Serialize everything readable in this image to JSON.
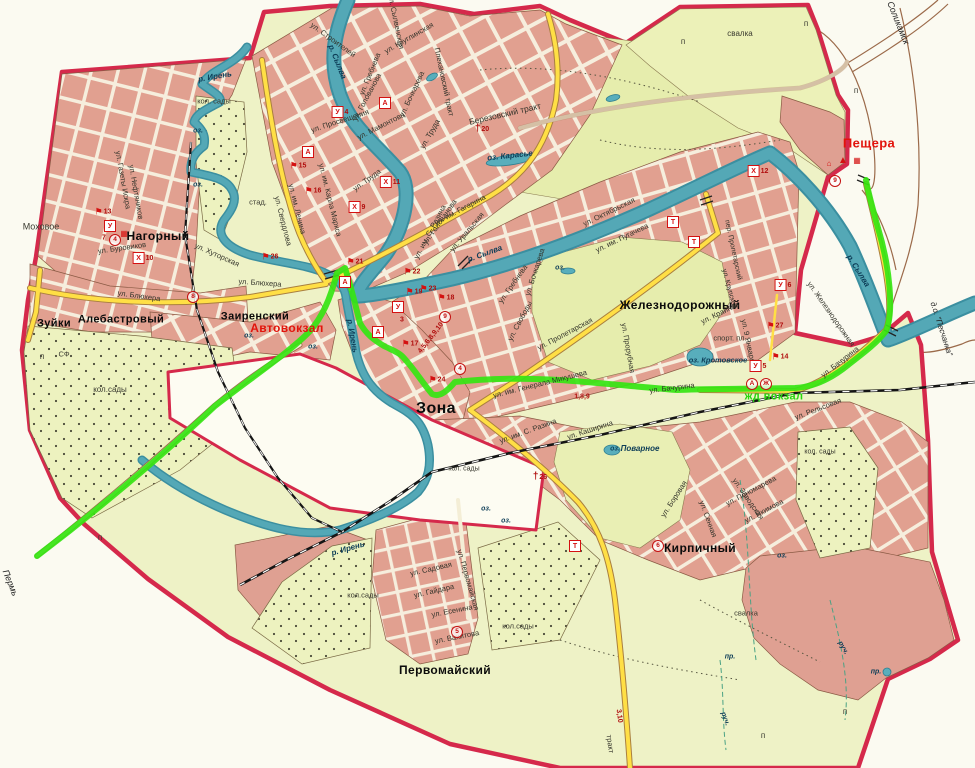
{
  "map": {
    "title": "План города (Кунгур)",
    "colors": {
      "boundary": "#d5294b",
      "water": "#4aa0ae",
      "route_highlight": "#35e512",
      "main_road": "#ffdf45",
      "urban_block": "#e1a090",
      "land": "#eef2c6",
      "park": "#e6edad",
      "railway": "#151515",
      "label_red": "#e2140c",
      "label_green": "#27d60e"
    },
    "labels": [
      {
        "t": "Нагорный",
        "x": 158,
        "y": 236,
        "cls": "town",
        "s": 12
      },
      {
        "t": "Зуйки",
        "x": 54,
        "y": 324,
        "cls": "town",
        "s": 11
      },
      {
        "t": "Алебастровый",
        "x": 121,
        "y": 320,
        "cls": "town",
        "s": 11
      },
      {
        "t": "Заиренский",
        "x": 255,
        "y": 317,
        "cls": "town",
        "s": 11
      },
      {
        "t": "Зона",
        "x": 436,
        "y": 409,
        "cls": "town",
        "s": 16
      },
      {
        "t": "Железнодорожный",
        "x": 680,
        "y": 305,
        "cls": "town",
        "s": 12
      },
      {
        "t": "Кирпичный",
        "x": 700,
        "y": 548,
        "cls": "town",
        "s": 12
      },
      {
        "t": "Первомайский",
        "x": 445,
        "y": 670,
        "cls": "town",
        "s": 12
      },
      {
        "t": "Моховое",
        "x": 41,
        "y": 227,
        "cls": "poi",
        "s": 9
      },
      {
        "t": "Пещера",
        "x": 869,
        "y": 143,
        "cls": "town-red",
        "s": 13
      },
      {
        "t": "Автовокзал",
        "x": 287,
        "y": 328,
        "cls": "town-red",
        "s": 12
      },
      {
        "t": "жд вокзал",
        "x": 774,
        "y": 397,
        "cls": "town-green",
        "s": 11
      },
      {
        "t": "Соликамск",
        "x": 898,
        "y": 23,
        "r": 68,
        "cls": "dir"
      },
      {
        "t": "Пермь",
        "x": 10,
        "y": 583,
        "r": 68,
        "cls": "dir"
      },
      {
        "t": "д.о. \"Песчанка\"",
        "x": 941,
        "y": 329,
        "r": 72,
        "cls": "dir",
        "s": 8
      },
      {
        "t": "ул. Строителей",
        "x": 333,
        "y": 40,
        "r": 36,
        "cls": "street"
      },
      {
        "t": "ул. Сылвенская",
        "x": 396,
        "y": 22,
        "r": 78,
        "cls": "street"
      },
      {
        "t": "ул. Круглинская",
        "x": 409,
        "y": 38,
        "r": -30,
        "cls": "street"
      },
      {
        "t": "Плехановский тракт",
        "x": 444,
        "y": 82,
        "r": 78,
        "cls": "street"
      },
      {
        "t": "Березовский тракт",
        "x": 505,
        "y": 114,
        "r": -13,
        "cls": "street",
        "s": 8.5
      },
      {
        "t": "ул. Труда",
        "x": 367,
        "y": 180,
        "r": -36,
        "cls": "street"
      },
      {
        "t": "ул. Труда",
        "x": 430,
        "y": 134,
        "r": -60,
        "cls": "street"
      },
      {
        "t": "ул. им. Карла Маркса",
        "x": 330,
        "y": 200,
        "r": 76,
        "cls": "street"
      },
      {
        "t": "ул. им. Ленина",
        "x": 297,
        "y": 209,
        "r": 76,
        "cls": "street"
      },
      {
        "t": "ул. Свердлова",
        "x": 283,
        "y": 221,
        "r": 76,
        "cls": "street"
      },
      {
        "t": "ул. им. Гагарина",
        "x": 460,
        "y": 210,
        "r": -28,
        "cls": "street"
      },
      {
        "t": "ул. Уральская",
        "x": 467,
        "y": 232,
        "r": -50,
        "cls": "street"
      },
      {
        "t": "ул. Голованова",
        "x": 440,
        "y": 222,
        "r": -55,
        "cls": "street"
      },
      {
        "t": "ул. Голованова",
        "x": 367,
        "y": 97,
        "r": -62,
        "cls": "street"
      },
      {
        "t": "ул. Гребнева",
        "x": 370,
        "y": 74,
        "r": -68,
        "cls": "street"
      },
      {
        "t": "ул. Гребнева",
        "x": 513,
        "y": 284,
        "r": -55,
        "cls": "street"
      },
      {
        "t": "ул. Мамонтова",
        "x": 381,
        "y": 126,
        "r": -27,
        "cls": "street"
      },
      {
        "t": "ул. Бочкарева",
        "x": 412,
        "y": 94,
        "r": -65,
        "cls": "street"
      },
      {
        "t": "ул. Бочкарева",
        "x": 535,
        "y": 272,
        "r": -72,
        "cls": "street"
      },
      {
        "t": "ул. Просвещения",
        "x": 340,
        "y": 121,
        "r": -18,
        "cls": "street"
      },
      {
        "t": "ул. Газеты Искра",
        "x": 123,
        "y": 180,
        "r": 80,
        "cls": "street"
      },
      {
        "t": "ул. Нефтяников",
        "x": 136,
        "y": 192,
        "r": 80,
        "cls": "street"
      },
      {
        "t": "ул. Буровиков",
        "x": 122,
        "y": 248,
        "r": -8,
        "cls": "street"
      },
      {
        "t": "ул. Блюхера",
        "x": 139,
        "y": 296,
        "r": 8,
        "cls": "street"
      },
      {
        "t": "ул. Блюхера",
        "x": 260,
        "y": 283,
        "r": 4,
        "cls": "street"
      },
      {
        "t": "ул. Хуторская",
        "x": 217,
        "y": 255,
        "r": 24,
        "cls": "street"
      },
      {
        "t": "ул. Свободы",
        "x": 520,
        "y": 321,
        "r": -62,
        "cls": "street"
      },
      {
        "t": "ул. Пролетарская",
        "x": 565,
        "y": 334,
        "r": -28,
        "cls": "street"
      },
      {
        "t": "ул. им. Генерала Микушева",
        "x": 540,
        "y": 384,
        "r": -14,
        "cls": "street"
      },
      {
        "t": "ул. Бачурина",
        "x": 672,
        "y": 388,
        "r": -7,
        "cls": "street"
      },
      {
        "t": "ул. Бачурина",
        "x": 840,
        "y": 362,
        "r": -38,
        "cls": "street"
      },
      {
        "t": "ул. Октябрьская",
        "x": 609,
        "y": 212,
        "r": -26,
        "cls": "street"
      },
      {
        "t": "ул. им. Пугачева",
        "x": 622,
        "y": 238,
        "r": -26,
        "cls": "street"
      },
      {
        "t": "ул. 9 Января",
        "x": 748,
        "y": 341,
        "r": 78,
        "cls": "street"
      },
      {
        "t": "ул. Железнодорожная",
        "x": 831,
        "y": 314,
        "r": 55,
        "cls": "street"
      },
      {
        "t": "ул. Крайняя",
        "x": 720,
        "y": 313,
        "r": -26,
        "cls": "street"
      },
      {
        "t": "пер. Пролетарский",
        "x": 733,
        "y": 250,
        "r": 78,
        "cls": "street",
        "s": 7
      },
      {
        "t": "ул. Прорубная",
        "x": 628,
        "y": 348,
        "r": 80,
        "cls": "street"
      },
      {
        "t": "ул. им. С. Разина",
        "x": 430,
        "y": 232,
        "r": -62,
        "cls": "street"
      },
      {
        "t": "ул. им. С. Разина",
        "x": 528,
        "y": 431,
        "r": -20,
        "cls": "street"
      },
      {
        "t": "ул. Каширина",
        "x": 590,
        "y": 430,
        "r": -18,
        "cls": "street"
      },
      {
        "t": "ул. Боровая",
        "x": 674,
        "y": 499,
        "r": -57,
        "cls": "street"
      },
      {
        "t": "ул. Заводская",
        "x": 748,
        "y": 499,
        "r": 55,
        "cls": "street"
      },
      {
        "t": "ул. Пономарева",
        "x": 751,
        "y": 491,
        "r": -28,
        "cls": "street"
      },
      {
        "t": "ул. Сенная",
        "x": 708,
        "y": 519,
        "r": 70,
        "cls": "street"
      },
      {
        "t": "ул. Якимова",
        "x": 764,
        "y": 511,
        "r": -28,
        "cls": "street"
      },
      {
        "t": "ул. Садовая",
        "x": 431,
        "y": 569,
        "r": -13,
        "cls": "street"
      },
      {
        "t": "ул. Гайдара",
        "x": 434,
        "y": 591,
        "r": -13,
        "cls": "street"
      },
      {
        "t": "ул. Есенина",
        "x": 452,
        "y": 611,
        "r": -11,
        "cls": "street"
      },
      {
        "t": "ул. Вахитова",
        "x": 457,
        "y": 637,
        "r": -11,
        "cls": "street"
      },
      {
        "t": "ул. Первомайская",
        "x": 468,
        "y": 580,
        "r": 74,
        "cls": "street"
      },
      {
        "t": "ул. Рельсовая",
        "x": 818,
        "y": 409,
        "r": -21,
        "cls": "street"
      },
      {
        "t": "ул. Крупской",
        "x": 729,
        "y": 289,
        "r": 75,
        "cls": "street",
        "s": 7
      },
      {
        "t": "тракт",
        "x": 610,
        "y": 744,
        "r": 82,
        "cls": "street"
      },
      {
        "t": "р. Ирень",
        "x": 215,
        "y": 77,
        "r": -10,
        "cls": "water"
      },
      {
        "t": "р. Ирень",
        "x": 352,
        "y": 336,
        "r": 80,
        "cls": "water"
      },
      {
        "t": "р. Ирень",
        "x": 348,
        "y": 549,
        "r": -16,
        "cls": "water"
      },
      {
        "t": "р. Сылва",
        "x": 337,
        "y": 62,
        "r": 68,
        "cls": "water"
      },
      {
        "t": "р. Сылва",
        "x": 485,
        "y": 254,
        "r": -20,
        "cls": "water"
      },
      {
        "t": "р. Сылва",
        "x": 858,
        "y": 271,
        "r": 58,
        "cls": "water"
      },
      {
        "t": "оз. Карасье",
        "x": 510,
        "y": 156,
        "r": -6,
        "cls": "water"
      },
      {
        "t": "оз. Кротовское",
        "x": 718,
        "y": 360,
        "cls": "water",
        "s": 7.5
      },
      {
        "t": "Поварное",
        "x": 640,
        "y": 449,
        "cls": "water",
        "s": 8
      },
      {
        "t": "оз.",
        "x": 615,
        "y": 449,
        "cls": "water",
        "s": 7
      },
      {
        "t": "оз.",
        "x": 198,
        "y": 131,
        "cls": "water",
        "s": 7
      },
      {
        "t": "оз.",
        "x": 198,
        "y": 185,
        "cls": "water",
        "s": 7
      },
      {
        "t": "оз.",
        "x": 249,
        "y": 336,
        "cls": "water",
        "s": 7
      },
      {
        "t": "оз.",
        "x": 313,
        "y": 347,
        "cls": "water",
        "s": 7
      },
      {
        "t": "оз.",
        "x": 486,
        "y": 509,
        "cls": "water",
        "s": 7
      },
      {
        "t": "оз.",
        "x": 506,
        "y": 521,
        "cls": "water",
        "s": 7
      },
      {
        "t": "оз.",
        "x": 560,
        "y": 268,
        "cls": "water",
        "s": 7
      },
      {
        "t": "оз.",
        "x": 782,
        "y": 556,
        "cls": "water",
        "s": 7
      },
      {
        "t": "руч.",
        "x": 843,
        "y": 648,
        "r": 60,
        "cls": "water",
        "s": 7
      },
      {
        "t": "руч.",
        "x": 725,
        "y": 719,
        "r": 70,
        "cls": "water",
        "s": 7
      },
      {
        "t": "пр.",
        "x": 876,
        "y": 672,
        "cls": "water",
        "s": 7
      },
      {
        "t": "пр.",
        "x": 730,
        "y": 657,
        "cls": "water",
        "s": 7
      },
      {
        "t": "спорт. пл.",
        "x": 730,
        "y": 338,
        "cls": "poi",
        "s": 7.5
      },
      {
        "t": "кол. сады",
        "x": 214,
        "y": 101,
        "cls": "poi"
      },
      {
        "t": "кол.сады",
        "x": 110,
        "y": 390,
        "cls": "poi",
        "s": 8
      },
      {
        "t": "кол.сады",
        "x": 363,
        "y": 595,
        "cls": "poi"
      },
      {
        "t": "кол.сады",
        "x": 518,
        "y": 626,
        "cls": "poi"
      },
      {
        "t": "кол. сады",
        "x": 820,
        "y": 452,
        "cls": "poi",
        "s": 7
      },
      {
        "t": "кол. сады",
        "x": 464,
        "y": 469,
        "cls": "poi",
        "s": 7
      },
      {
        "t": "свалка",
        "x": 740,
        "y": 34,
        "cls": "poi",
        "s": 8
      },
      {
        "t": "свалка",
        "x": 746,
        "y": 613,
        "cls": "poi",
        "s": 7.5
      },
      {
        "t": "стад.",
        "x": 258,
        "y": 202,
        "cls": "poi"
      },
      {
        "t": "СФ",
        "x": 64,
        "y": 354,
        "cls": "poi"
      },
      {
        "t": "п",
        "x": 683,
        "y": 42,
        "cls": "poi",
        "s": 8
      },
      {
        "t": "п",
        "x": 806,
        "y": 24,
        "cls": "poi",
        "s": 8
      },
      {
        "t": "п",
        "x": 856,
        "y": 91,
        "cls": "poi",
        "s": 8
      },
      {
        "t": "п",
        "x": 42,
        "y": 357,
        "cls": "poi",
        "s": 8
      },
      {
        "t": "п",
        "x": 100,
        "y": 538,
        "cls": "poi",
        "s": 8
      },
      {
        "t": "п",
        "x": 763,
        "y": 736,
        "cls": "poi",
        "s": 8
      },
      {
        "t": "п",
        "x": 845,
        "y": 712,
        "cls": "poi",
        "s": 8
      },
      {
        "t": "7",
        "x": 104,
        "y": 238,
        "cls": "num"
      },
      {
        "t": "3",
        "x": 402,
        "y": 320,
        "cls": "num"
      },
      {
        "t": "4,5,6,8,9,10",
        "x": 431,
        "y": 338,
        "r": -52,
        "cls": "num"
      },
      {
        "t": "1,8,9",
        "x": 582,
        "y": 397,
        "cls": "num"
      },
      {
        "t": "3,10",
        "x": 619,
        "y": 716,
        "r": 82,
        "cls": "num"
      }
    ],
    "badges": [
      {
        "kind": "box",
        "g": "А",
        "x": 385,
        "y": 103
      },
      {
        "kind": "box",
        "g": "А",
        "x": 308,
        "y": 152
      },
      {
        "kind": "box",
        "g": "А",
        "x": 345,
        "y": 282
      },
      {
        "kind": "box",
        "g": "А",
        "x": 378,
        "y": 332
      },
      {
        "kind": "box",
        "g": "У",
        "x": 110,
        "y": 226
      },
      {
        "kind": "box",
        "g": "У",
        "x": 398,
        "y": 307
      },
      {
        "kind": "box",
        "g": "У",
        "x": 758,
        "y": 366,
        "n": "5"
      },
      {
        "kind": "box",
        "g": "У",
        "x": 783,
        "y": 285,
        "n": "6"
      },
      {
        "kind": "box",
        "g": "У",
        "x": 340,
        "y": 112,
        "n": "4"
      },
      {
        "kind": "box",
        "g": "Х",
        "x": 357,
        "y": 207,
        "n": "9"
      },
      {
        "kind": "box",
        "g": "Х",
        "x": 390,
        "y": 182,
        "n": "11"
      },
      {
        "kind": "box",
        "g": "Х",
        "x": 143,
        "y": 258,
        "n": "10"
      },
      {
        "kind": "box",
        "g": "Х",
        "x": 758,
        "y": 171,
        "n": "12"
      },
      {
        "kind": "box",
        "g": "Т",
        "x": 673,
        "y": 222
      },
      {
        "kind": "box",
        "g": "Т",
        "x": 694,
        "y": 242
      },
      {
        "kind": "box",
        "g": "Т",
        "x": 575,
        "y": 546
      },
      {
        "kind": "circle",
        "g": "4",
        "x": 115,
        "y": 240
      },
      {
        "kind": "circle",
        "g": "8",
        "x": 193,
        "y": 297
      },
      {
        "kind": "circle",
        "g": "9",
        "x": 445,
        "y": 317
      },
      {
        "kind": "circle",
        "g": "4",
        "x": 460,
        "y": 369
      },
      {
        "kind": "circle",
        "g": "6",
        "x": 658,
        "y": 546
      },
      {
        "kind": "circle",
        "g": "5",
        "x": 457,
        "y": 632
      },
      {
        "kind": "circle",
        "g": "9",
        "x": 835,
        "y": 181
      },
      {
        "kind": "circle",
        "g": "А",
        "x": 752,
        "y": 384
      },
      {
        "kind": "circle",
        "g": "Ж",
        "x": 766,
        "y": 384
      },
      {
        "kind": "flag",
        "n": "13",
        "x": 103,
        "y": 212
      },
      {
        "kind": "flag",
        "n": "26",
        "x": 270,
        "y": 257
      },
      {
        "kind": "flag",
        "n": "21",
        "x": 355,
        "y": 262
      },
      {
        "kind": "flag",
        "n": "22",
        "x": 412,
        "y": 272
      },
      {
        "kind": "flag",
        "n": "15",
        "x": 298,
        "y": 166
      },
      {
        "kind": "flag",
        "n": "16",
        "x": 313,
        "y": 191
      },
      {
        "kind": "flag",
        "n": "19",
        "x": 414,
        "y": 292
      },
      {
        "kind": "flag",
        "n": "23",
        "x": 428,
        "y": 289
      },
      {
        "kind": "flag",
        "n": "18",
        "x": 446,
        "y": 298
      },
      {
        "kind": "flag",
        "n": "17",
        "x": 410,
        "y": 344
      },
      {
        "kind": "flag",
        "n": "24",
        "x": 437,
        "y": 380
      },
      {
        "kind": "flag",
        "n": "27",
        "x": 775,
        "y": 326
      },
      {
        "kind": "flag",
        "n": "14",
        "x": 780,
        "y": 357
      },
      {
        "kind": "cross",
        "n": "20",
        "x": 482,
        "y": 129
      },
      {
        "kind": "cross",
        "n": "26",
        "x": 540,
        "y": 477
      },
      {
        "kind": "bld",
        "x": 124,
        "y": 234
      },
      {
        "kind": "tent",
        "x": 843,
        "y": 161
      },
      {
        "kind": "bld",
        "x": 857,
        "y": 161
      },
      {
        "kind": "home",
        "x": 829,
        "y": 164
      }
    ]
  }
}
